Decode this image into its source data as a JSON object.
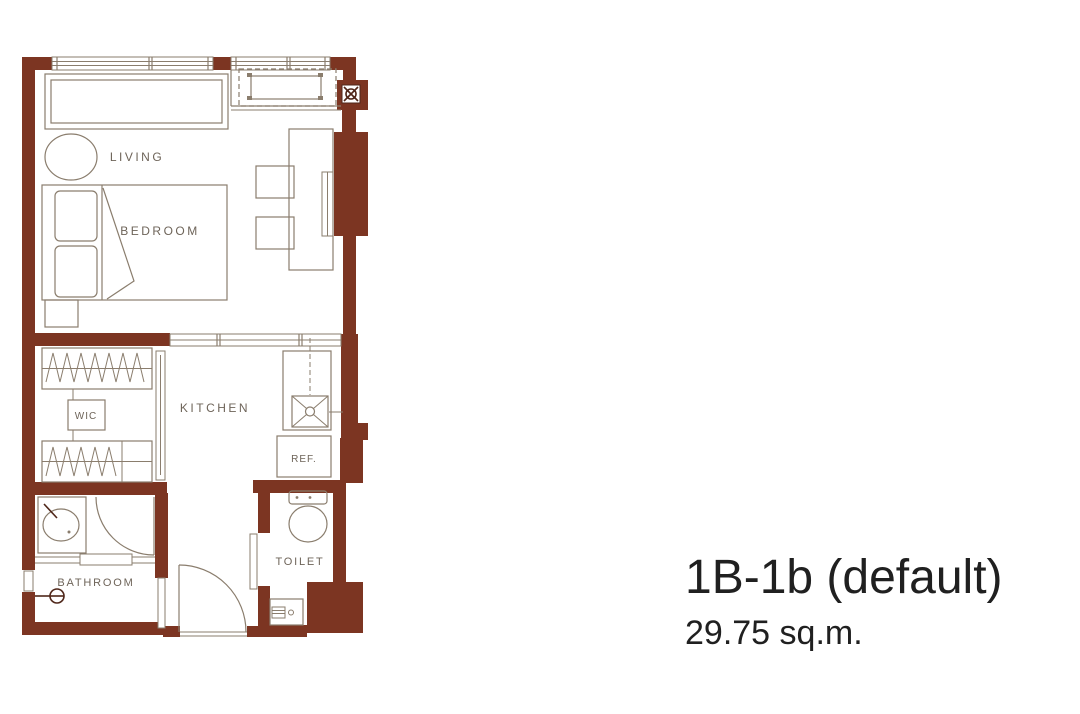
{
  "plan": {
    "unit_name": "1B-1b (default)",
    "unit_area": "29.75 sq.m.",
    "rooms": {
      "living": "LIVING",
      "bedroom": "BEDROOM",
      "kitchen": "KITCHEN",
      "wic": "WIC",
      "bathroom": "BATHROOM",
      "toilet": "TOILET",
      "refrigerator": "REF."
    },
    "colors": {
      "wall": "#7c3522",
      "furniture_line": "#8a7d6d",
      "label_text": "#6e6459",
      "title_text": "#202020",
      "background": "#ffffff"
    }
  }
}
